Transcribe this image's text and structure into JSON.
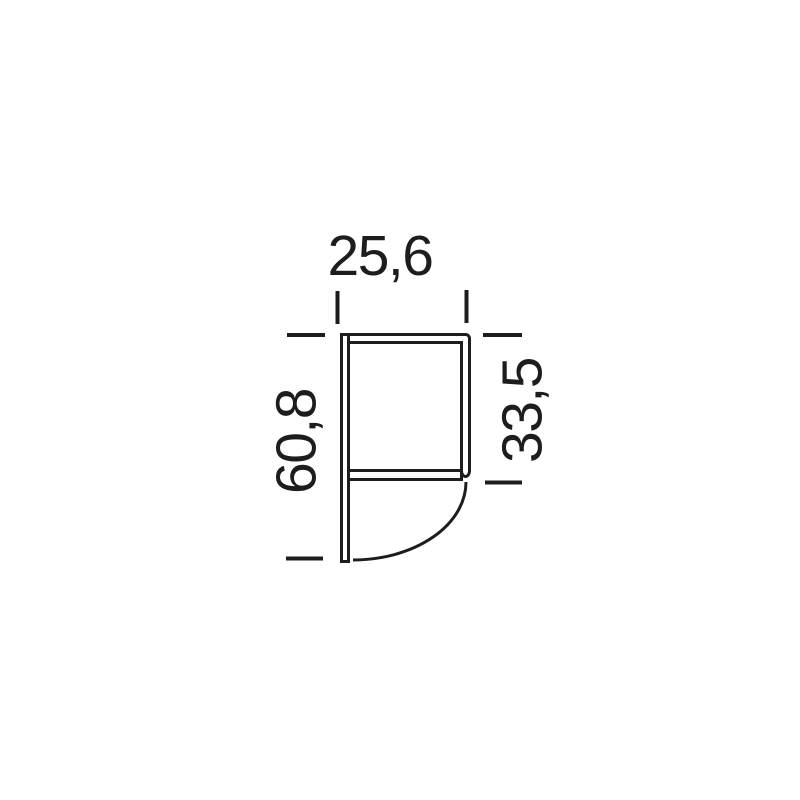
{
  "meta": {
    "background_color": "#ffffff",
    "line_color": "#1d1d1b",
    "description": "Technical side-profile dimension drawing of a cabinet/shelf unit with a curved lower front"
  },
  "drawing": {
    "dimensions": {
      "width": "25,6",
      "total_height": "60,8",
      "upper_section_height": "33,5"
    }
  }
}
